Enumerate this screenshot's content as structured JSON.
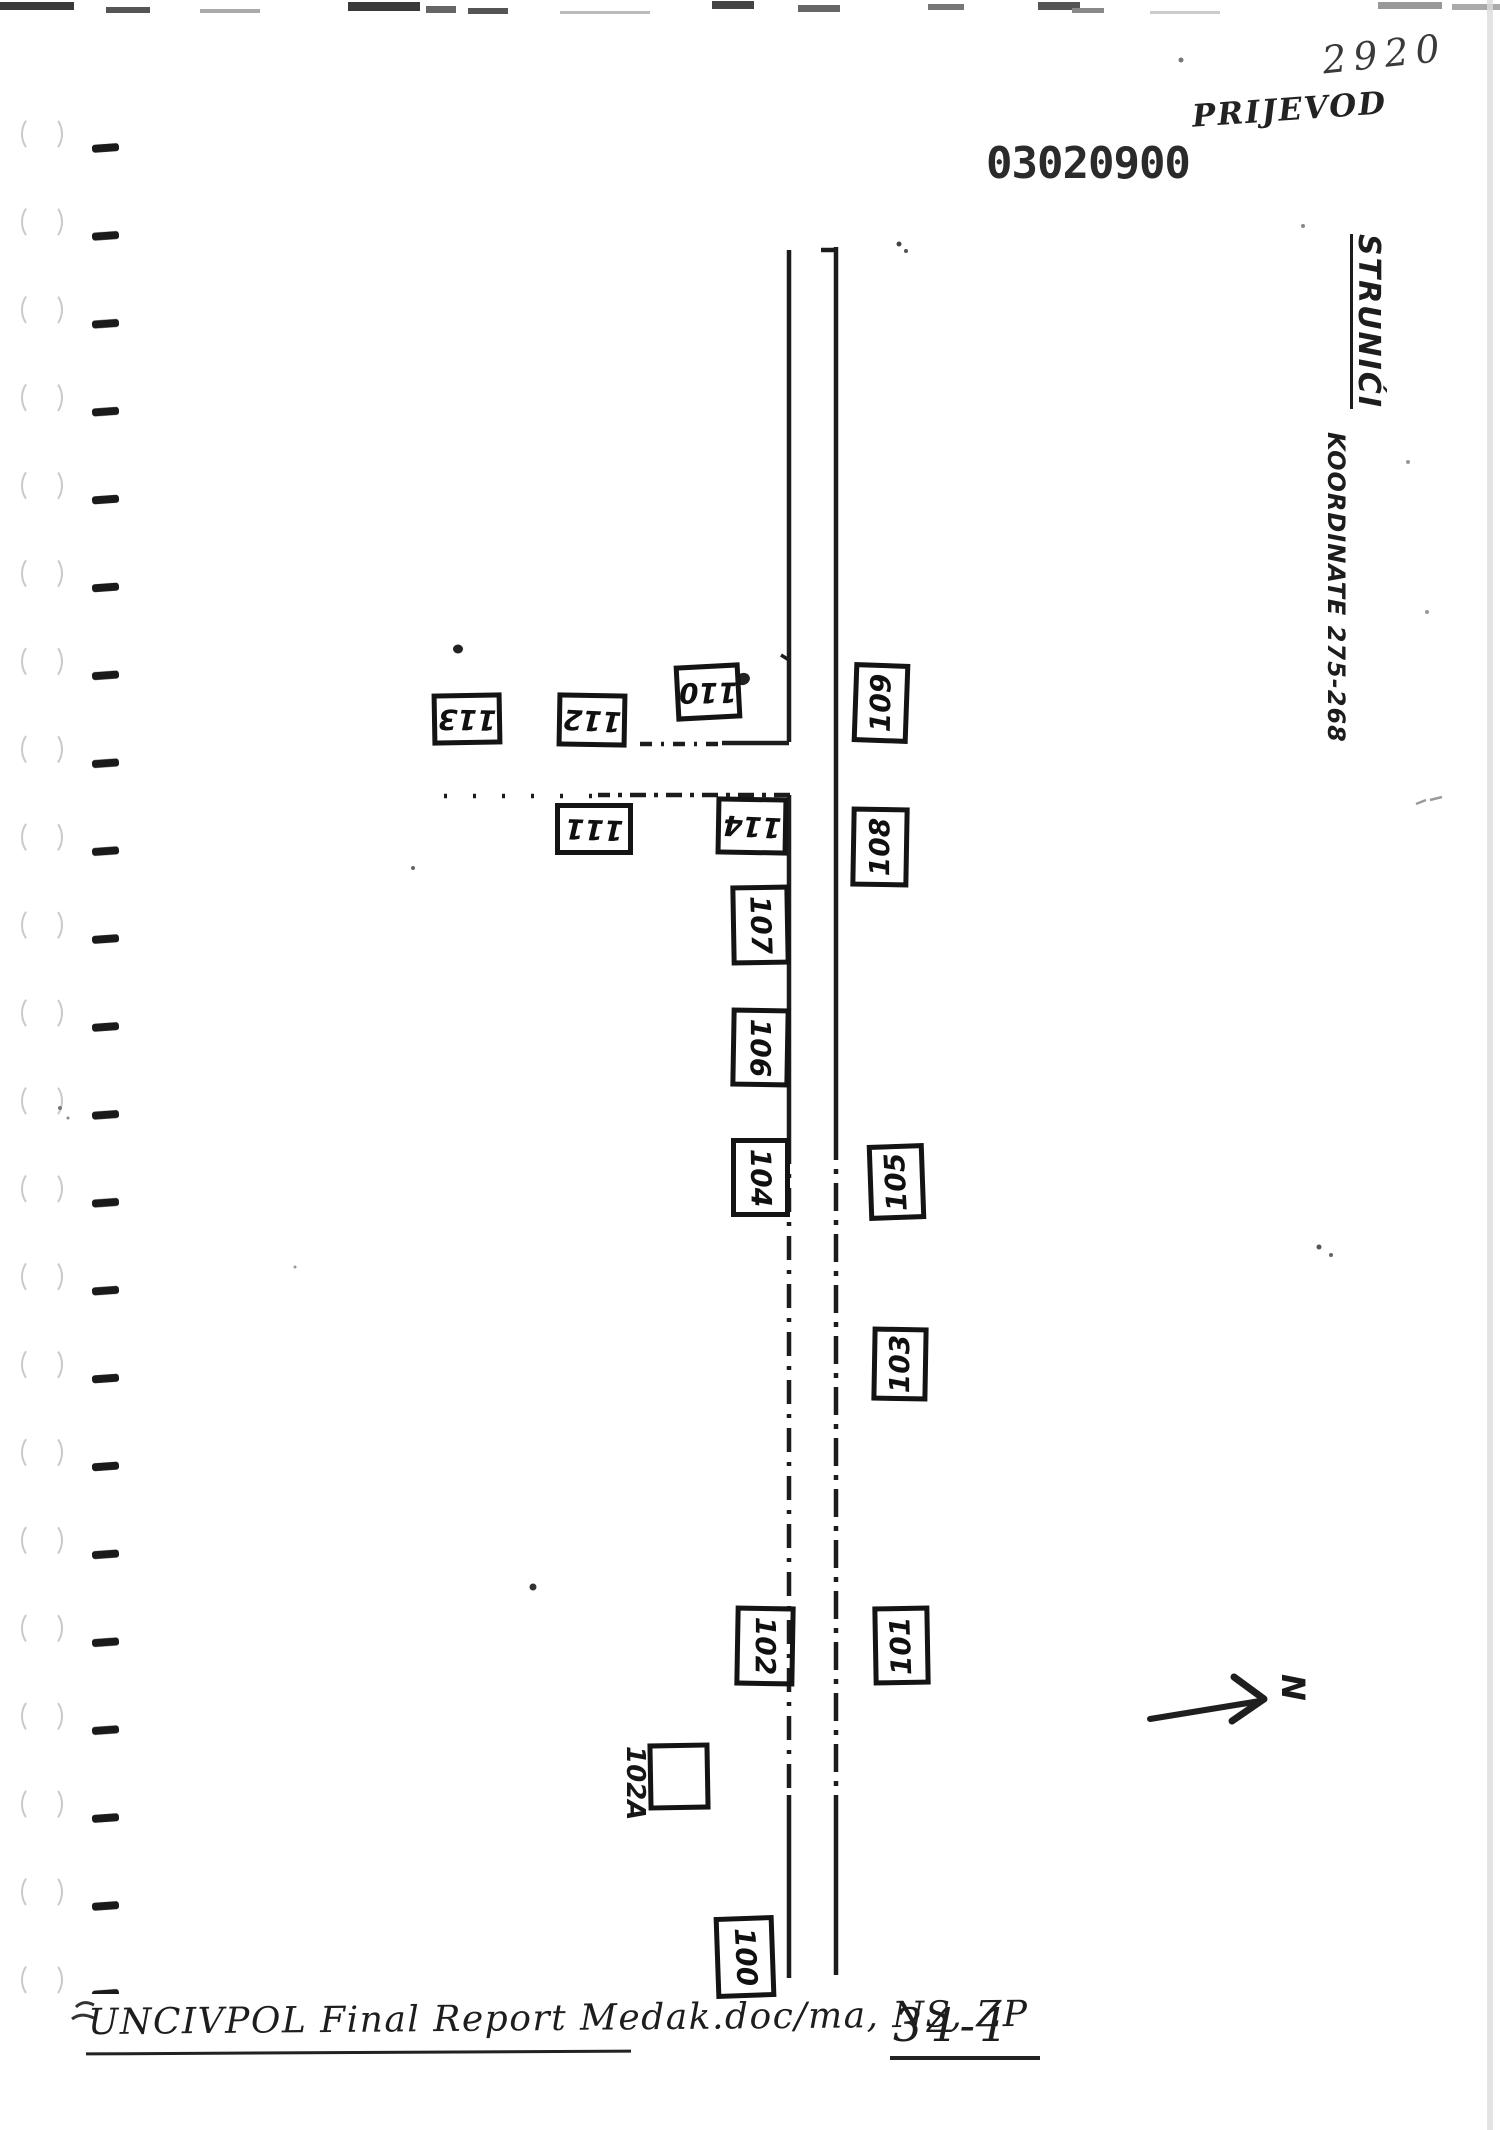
{
  "document": {
    "corner_number": "2920",
    "translation_note": "PRIJEVOD",
    "stamp_number": "03020900",
    "village_title": "STRUNIĆI",
    "coordinates": "KOORDINATE 275-268",
    "north_label": "N",
    "footer": "UNCIVPOL Final Report Medak.doc/ma, NS, ZP",
    "page_number": "34-1"
  },
  "map": {
    "houses": [
      {
        "label": "113"
      },
      {
        "label": "112"
      },
      {
        "label": "110"
      },
      {
        "label": "111"
      },
      {
        "label": "114"
      },
      {
        "label": "109"
      },
      {
        "label": "108"
      },
      {
        "label": "107"
      },
      {
        "label": "106"
      },
      {
        "label": "104"
      },
      {
        "label": "105"
      },
      {
        "label": "103"
      },
      {
        "label": "102"
      },
      {
        "label": "101"
      },
      {
        "label": "102A"
      },
      {
        "label": "100"
      }
    ]
  },
  "colors": {
    "ink": "#1c1c1c",
    "faint_marks": "#c9c9c9"
  }
}
